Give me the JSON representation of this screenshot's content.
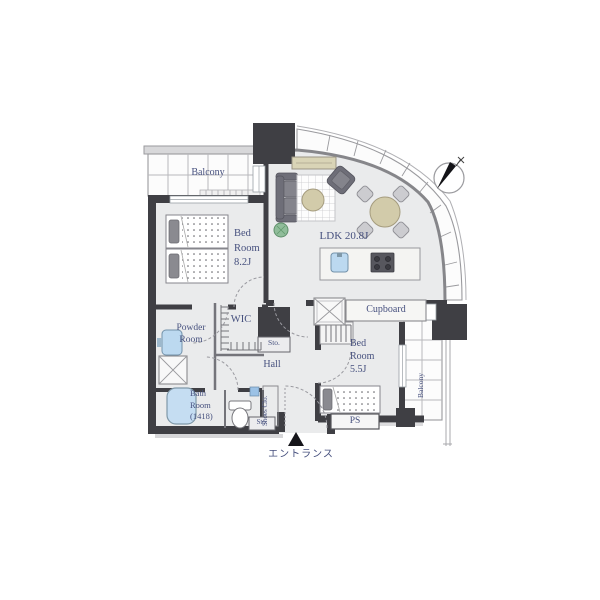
{
  "title": "apartment-floor-plan",
  "colors": {
    "wall": "#3f3f44",
    "floor": "#eaebec",
    "label": "#46507e",
    "grid": "#b8b8bc",
    "balcony_fill": "#fcfcfc",
    "water": "#bcd9f0",
    "tub": "#c5ddf2",
    "wood": "#d2cbaa",
    "tvboard": "#d9d4b6",
    "sofa": "#6e6e78",
    "cushion": "#84848c",
    "chair": "#ccccd0",
    "plant": "#90bd9a",
    "stove": "#57575e",
    "arc": "#9a9aa0",
    "dark": "#15151a"
  },
  "rooms": {
    "balcony_top": {
      "label": "Balcony"
    },
    "bedroom_main": {
      "line1": "Bed",
      "line2": "Room",
      "line3": "8.2J"
    },
    "ldk": {
      "label": "LDK 20.8J"
    },
    "cupboard": {
      "label": "Cupboard"
    },
    "bedroom_second": {
      "line1": "Bed",
      "line2": "Room",
      "line3": "5.5J"
    },
    "balcony_right": {
      "label": "Balcony"
    },
    "wic": {
      "label": "WIC"
    },
    "powder_room": {
      "line1": "Powder",
      "line2": "Room"
    },
    "storage_upper": {
      "label": "Sto."
    },
    "hall": {
      "label": "Hall"
    },
    "bathroom": {
      "line1": "Bath",
      "line2": "Room",
      "line3": "(1418)"
    },
    "shoes_closet": {
      "label": "Shoes Clo."
    },
    "storage_lower": {
      "label": "Sto."
    },
    "pipe_space": {
      "label": "PS"
    },
    "entrance": {
      "label": "エントランス"
    }
  },
  "icons": {
    "compass": "north-arrow"
  }
}
